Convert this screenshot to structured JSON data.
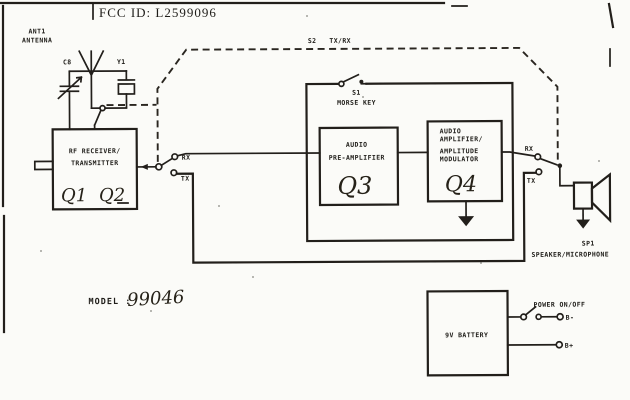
{
  "scan": {
    "fcc_id": "FCC ID: L2599096",
    "model_label": "MODEL :",
    "model_number": "99046"
  },
  "antenna": {
    "ref": "ANT1",
    "label": "ANTENNA"
  },
  "components": {
    "c8": "C8",
    "y1": "Y1"
  },
  "rf_box": {
    "line1": "RF RECEIVER/",
    "line2": "TRANSMITTER",
    "q1": "Q1",
    "q2": "Q2"
  },
  "s2_switch": {
    "ref": "S2",
    "label": "TX/RX"
  },
  "s1_switch": {
    "ref": "S1",
    "label": "MORSE KEY"
  },
  "preamp_box": {
    "line1": "AUDIO",
    "line2": "PRE-AMPLIFIER",
    "q3": "Q3"
  },
  "amp_box": {
    "line1": "AUDIO",
    "line2": "AMPLIFIER/",
    "line3": "AMPLITUDE",
    "line4": "MODULATOR",
    "q4": "Q4"
  },
  "left_switch": {
    "rx": "RX",
    "tx": "TX"
  },
  "right_switch": {
    "rx": "RX",
    "tx": "TX"
  },
  "speaker": {
    "ref": "SP1",
    "label": "SPEAKER/MICROPHONE"
  },
  "battery": {
    "label": "9V BATTERY",
    "power_label": "POWER ON/OFF",
    "neg_terminal": "B-",
    "pos_terminal": "B+"
  },
  "colors": {
    "ink": "#221f1b",
    "paper": "#fbfbf8"
  }
}
